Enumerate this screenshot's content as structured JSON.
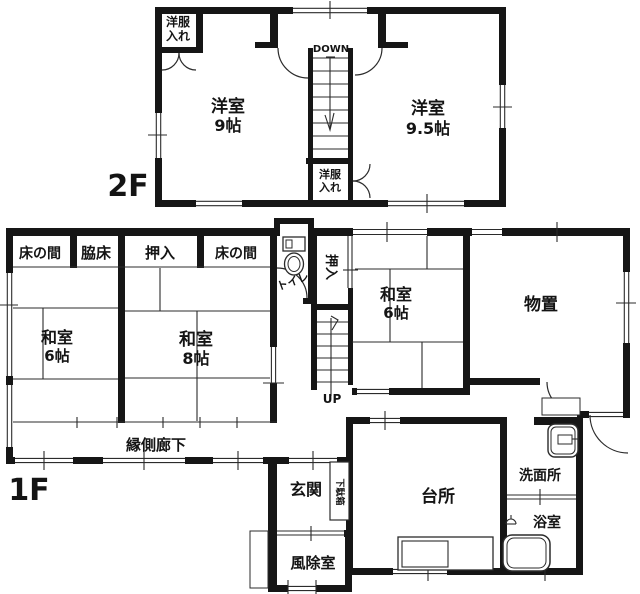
{
  "document": {
    "kind": "house-floor-plan",
    "colors": {
      "ink": "#161616",
      "line": "#2b2b2b",
      "bg": "#ffffff"
    }
  },
  "f2": {
    "floor_label": "2F",
    "closet_nw": [
      "洋服",
      "入れ"
    ],
    "west_room": [
      "洋室",
      "9帖"
    ],
    "east_room": [
      "洋室",
      "9.5帖"
    ],
    "stair_label": "DOWN",
    "closet_s": [
      "洋服",
      "入れ"
    ]
  },
  "f1": {
    "floor_label": "1F",
    "alcoves": [
      "床の間",
      "脇床",
      "押入",
      "床の間"
    ],
    "washitsu6w": [
      "和室",
      "6帖"
    ],
    "washitsu8": [
      "和室",
      "8帖"
    ],
    "toilet": "トイレ",
    "oshiire_stair": "押入",
    "washitsu6e": [
      "和室",
      "6帖"
    ],
    "monooki": "物置",
    "engawa": "縁側廊下",
    "up": "UP",
    "genkan": "玄関",
    "getabako": "下駄箱",
    "fujo": "風除室",
    "daidokoro": "台所",
    "senmenjo": "洗面所",
    "yokushitsu": "浴室"
  }
}
